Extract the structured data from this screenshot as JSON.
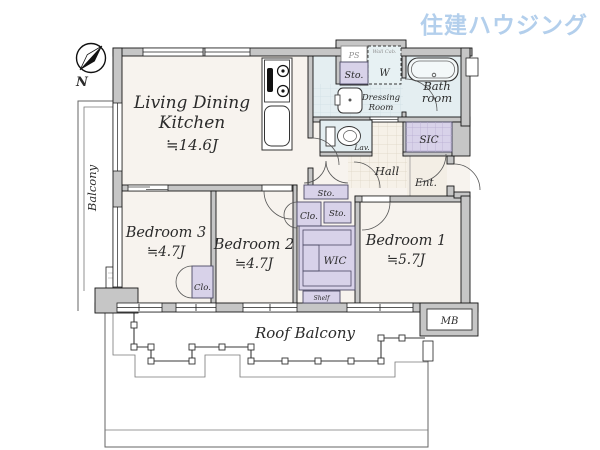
{
  "logo": {
    "text": "住建ハウジング"
  },
  "compass": {
    "north_label": "N"
  },
  "plan": {
    "rooms": {
      "ldk": {
        "line1": "Living Dining",
        "line2": "Kitchen",
        "size": "≒14.6J"
      },
      "bedroom1": {
        "name": "Bedroom 1",
        "size": "≒5.7J"
      },
      "bedroom2": {
        "name": "Bedroom 2",
        "size": "≒4.7J"
      },
      "bedroom3": {
        "name": "Bedroom 3",
        "size": "≒4.7J"
      },
      "bathroom": {
        "line1": "Bath",
        "line2": "room"
      },
      "dressing_room": {
        "line1": "Dressing",
        "line2": "Room"
      },
      "lavatory": {
        "label": "Lav."
      },
      "hall": {
        "label": "Hall"
      },
      "entrance": {
        "label": "Ent."
      },
      "shoes_in_closet": {
        "label": "SIC"
      },
      "balcony": {
        "label": "Balcony"
      },
      "roof_balcony": {
        "label": "Roof Balcony"
      },
      "meter_box": {
        "label": "MB"
      }
    },
    "storage": {
      "storage_label": "Sto.",
      "closet_label": "Clo.",
      "walk_in_closet_label": "WIC",
      "shelf_label": "Shelf",
      "pipe_space_label": "PS",
      "washer_label": "W",
      "wall_cabinet_label": "Wall Cab."
    },
    "colors": {
      "wet_area": "#e4eef1",
      "storage_area": "#d8d2e9",
      "floor": "#f7f3ee",
      "wall": "#c6c6c6",
      "logo_blue": "#b3cfec"
    }
  }
}
